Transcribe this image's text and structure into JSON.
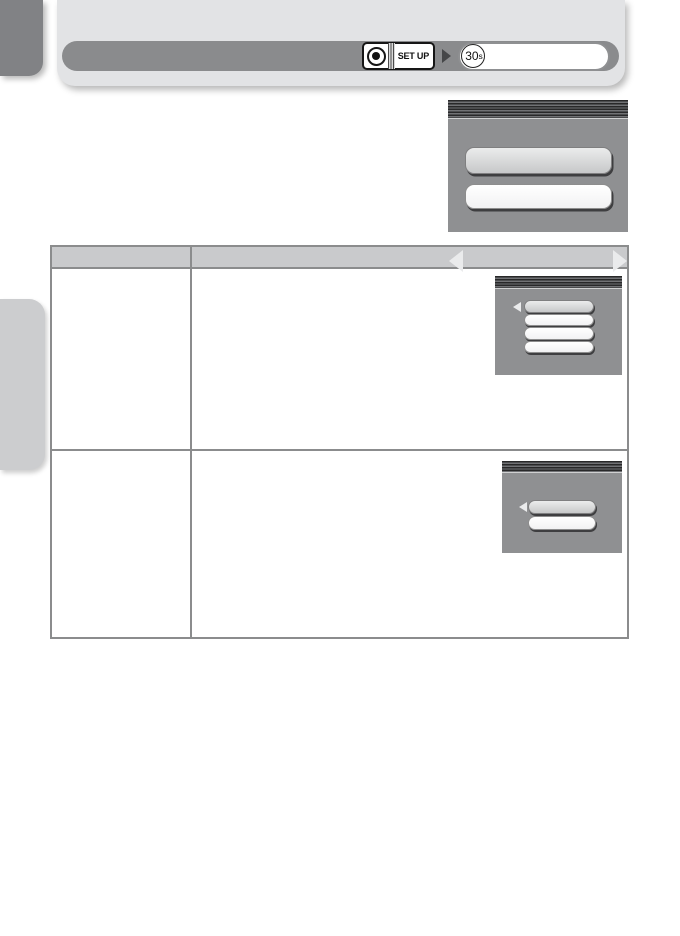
{
  "header": {
    "dial_label": "SET UP",
    "value_number": "30",
    "value_unit": "s"
  },
  "menus": {
    "setup_top": {
      "option_count": 2,
      "selected_index": 0,
      "arrows": [
        "left",
        "right"
      ]
    },
    "row1": {
      "option_count": 4,
      "selected_index": 0,
      "arrows": [
        "left"
      ]
    },
    "row2": {
      "option_count": 2,
      "selected_index": 0,
      "arrows": [
        "left"
      ]
    }
  },
  "table": {
    "columns": 2,
    "header_labels": [
      "",
      ""
    ],
    "body_rows": 2
  },
  "colors": {
    "card": "#e2e3e5",
    "control_bar": "#8a8b8d",
    "menu_body": "#8f9092",
    "menu_selected_pill": "#d2d3d4",
    "menu_pill": "#ffffff",
    "table_header_fill": "#c9cacc",
    "table_border": "#8b8c8d",
    "tab_dark": "#818285",
    "tab_light": "#cccdcf"
  }
}
